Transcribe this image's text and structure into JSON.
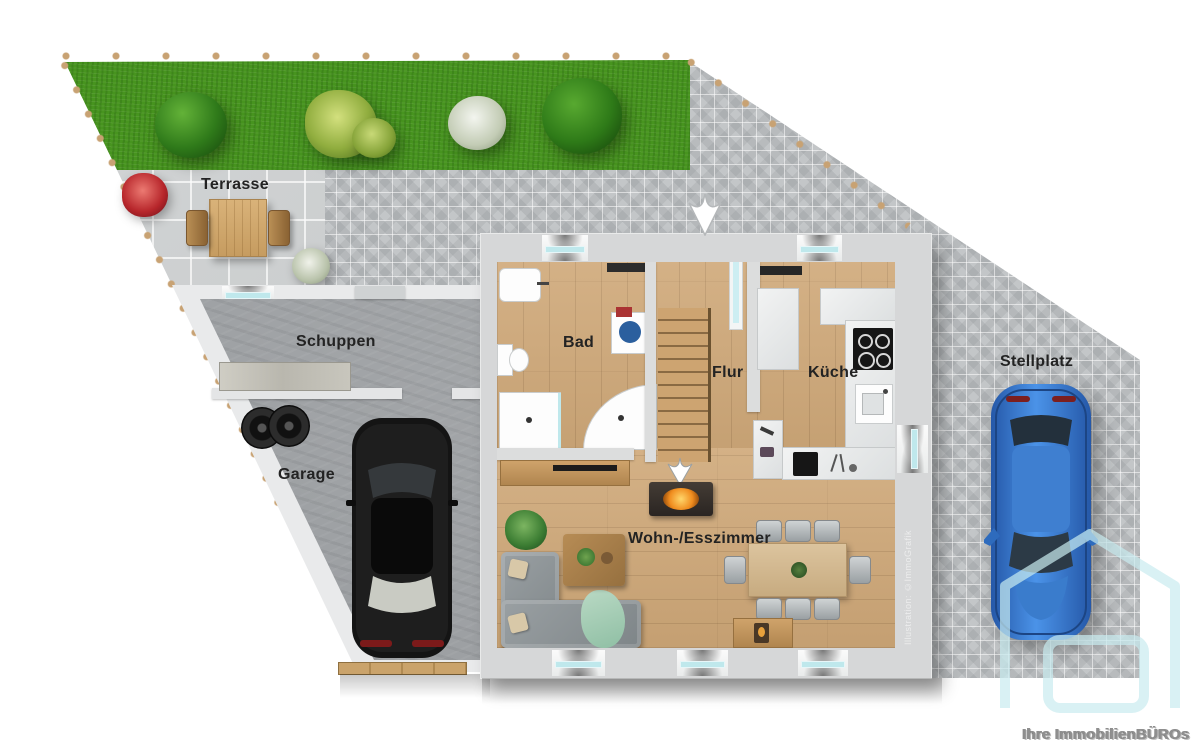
{
  "labels": {
    "terrasse": "Terrasse",
    "schuppen": "Schuppen",
    "garage": "Garage",
    "bad": "Bad",
    "flur": "Flur",
    "kueche": "Küche",
    "wohnesszimmer": "Wohn-/Esszimmer",
    "stellplatz": "Stellplatz"
  },
  "watermarks": {
    "credit": "Illustration: ©ImmoGrafik",
    "brand": "Ihre ImmobilienBÜROs"
  },
  "colors": {
    "grass": "#47941f",
    "paving": "#c3c6c8",
    "terrace_tile": "#c9cccd",
    "wall": "#d6d7d8",
    "concrete": "#9da0a3",
    "wood_floor": "#cfa878",
    "window_glass": "#bfe8ec",
    "car_blue": "#2f72c8",
    "boundary_stone": "#c8a273",
    "watermark_cyan": "#c9ecf0"
  }
}
